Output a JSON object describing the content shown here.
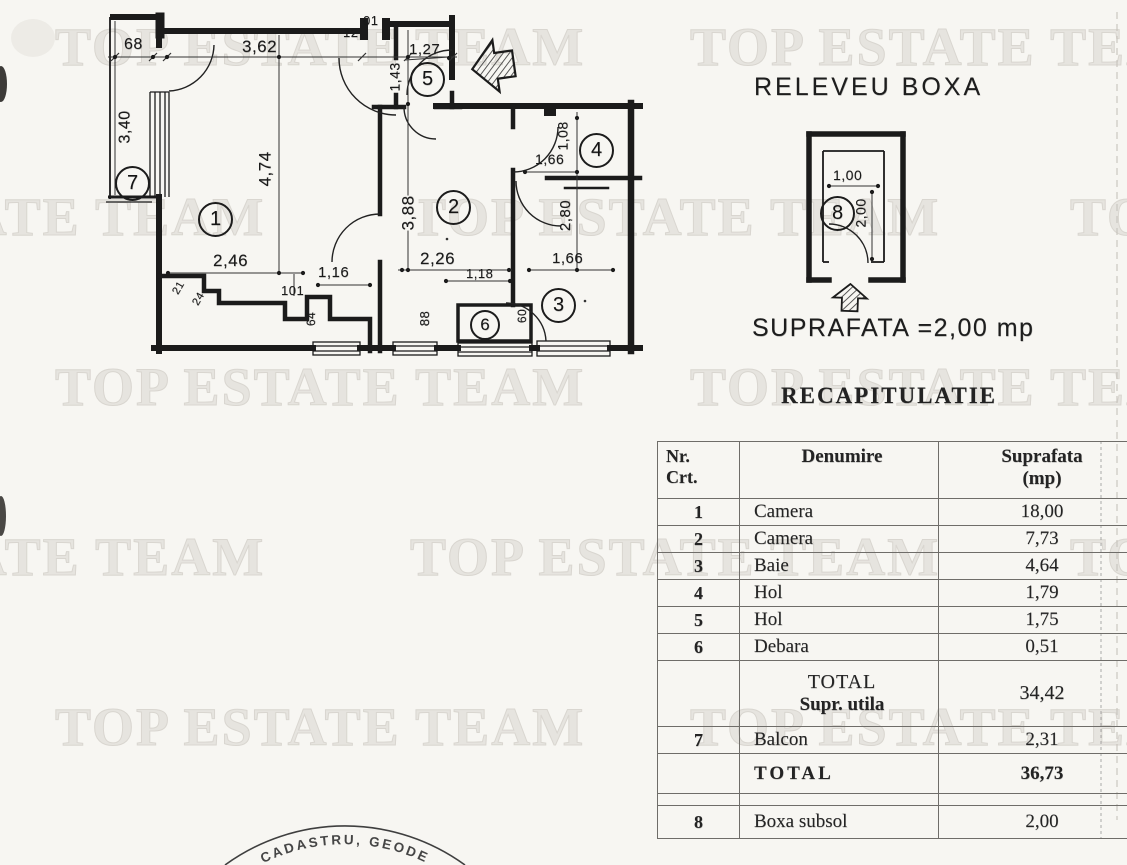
{
  "watermark": {
    "text": "TOP ESTATE TEAM"
  },
  "plan": {
    "rooms": {
      "r1": "1",
      "r2": "2",
      "r3": "3",
      "r4": "4",
      "r5": "5",
      "r6": "6",
      "r7": "7"
    },
    "dims": {
      "top_68": "68",
      "top_3_62": "3,62",
      "top_12": "12",
      "top_01": "01",
      "hol_1_27": "1,27",
      "hol_1_43": "1,43",
      "balcon_3_40": "3,40",
      "camera1_4_74": "4,74",
      "camera2_3_88": "3,88",
      "hol4_1_08": "1,08",
      "hol4_1_66": "1,66",
      "baie_2_80": "2,80",
      "camera1_2_46": "2,46",
      "corridor_1_16": "1,16",
      "camera2_2_26": "2,26",
      "corridor_1_18": "1,18",
      "baie_1_66": "1,66",
      "step_101": "101",
      "step_21": "21",
      "step_24": "24",
      "step_64": "64",
      "corridor_88": "88",
      "debara_60": "60"
    }
  },
  "boxa": {
    "title": "RELEVEU BOXA",
    "room_number": "8",
    "dim_1_00": "1,00",
    "dim_2_00": "2,00",
    "area_text": "SUPRAFATA =2,00 mp"
  },
  "recap": {
    "title": "RECAPITULATIE",
    "header": {
      "nr_line1": "Nr.",
      "nr_line2": "Crt.",
      "denumire": "Denumire",
      "suprafata_line1": "Suprafata",
      "suprafata_line2": "(mp)"
    },
    "rows": [
      {
        "nr": "1",
        "name": "Camera",
        "area": "18,00"
      },
      {
        "nr": "2",
        "name": "Camera",
        "area": "7,73"
      },
      {
        "nr": "3",
        "name": "Baie",
        "area": "4,64"
      },
      {
        "nr": "4",
        "name": "Hol",
        "area": "1,79"
      },
      {
        "nr": "5",
        "name": "Hol",
        "area": "1,75"
      },
      {
        "nr": "6",
        "name": "Debara",
        "area": "0,51"
      }
    ],
    "total_utila": {
      "label_line1": "TOTAL",
      "label_line2": "Supr. utila",
      "area": "34,42"
    },
    "balcon": {
      "nr": "7",
      "name": "Balcon",
      "area": "2,31"
    },
    "total": {
      "label": "TOTAL",
      "area": "36,73"
    },
    "boxa_row": {
      "nr": "8",
      "name": "Boxa subsol",
      "area": "2,00"
    }
  },
  "stamp": {
    "text": "CADASTRU, GEODE"
  }
}
